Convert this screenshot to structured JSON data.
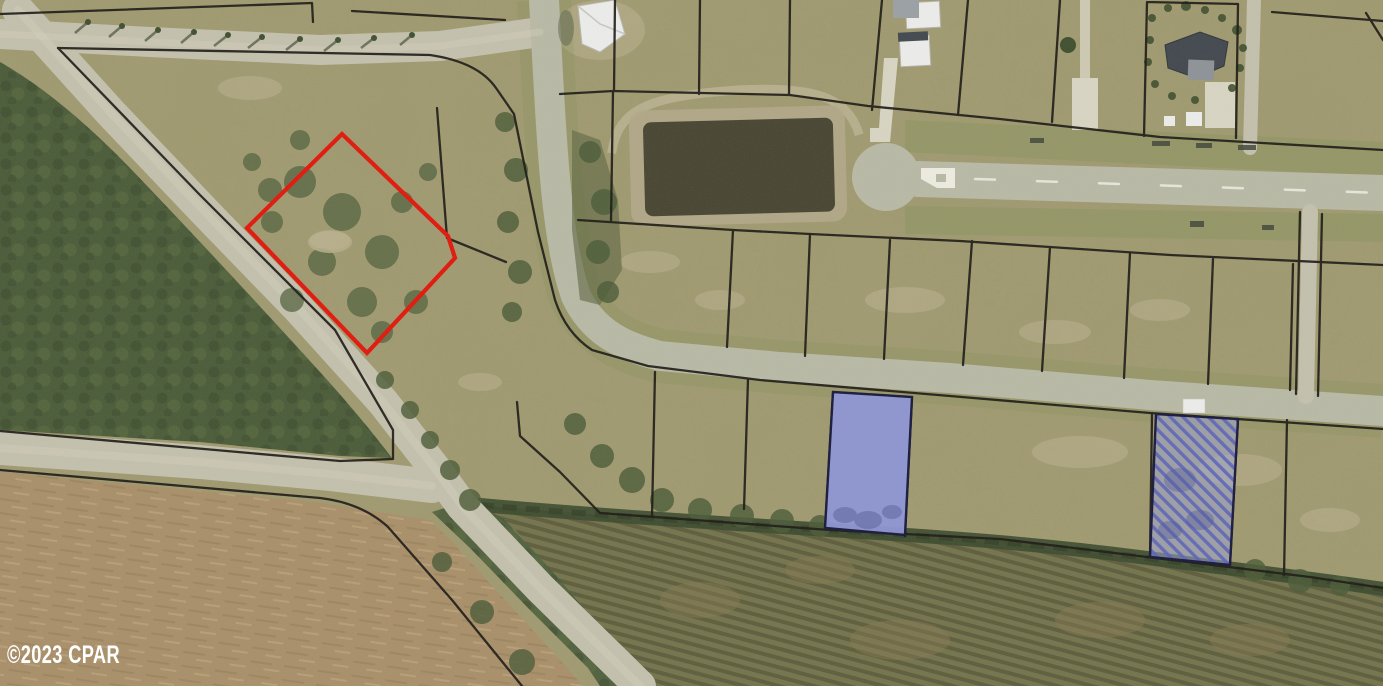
{
  "watermark": {
    "text": "©2023 CPAR"
  },
  "map_type": "aerial-parcel-map",
  "colors": {
    "field": "#9f996e",
    "field_light": "#bdb491",
    "grass_verge": "#85935a",
    "forest": "#485a37",
    "forest_dark": "#39482b",
    "forest_light": "#5d7042",
    "brush": "#4a5a36",
    "brush_light": "#51613c",
    "dirt": "#a98f69",
    "dirt_streak": "#8f7753",
    "dirt_light": "#c2ab83",
    "orchard": "#72724b",
    "orchard_row": "#5c5c3b",
    "orchard_patch": "#8a7a52",
    "road": "#c4c1ae",
    "road_worn": "#dad6c2",
    "road_gravel": "#b9baa6",
    "pond": "#454330",
    "pond_rim": "#b2a989",
    "berm": "#bdb494",
    "marsh": "#5a6440",
    "parcel_line": "#1a1713",
    "subject_outline": "#e31408",
    "highlight_fill": "#8d95d7",
    "highlight_stroke": "#16163a",
    "hatch_stripe": "#5a64bb",
    "hatch_bg": "#9ba3de",
    "house_white": "#eeefed",
    "house_dark": "#3f464d",
    "driveway": "#d9d6c4",
    "tree": "#3c4d2c",
    "tree_shadow": "#2e3b24",
    "road_marking": "#f2f0e6",
    "watermark_color": "#ffffff"
  }
}
